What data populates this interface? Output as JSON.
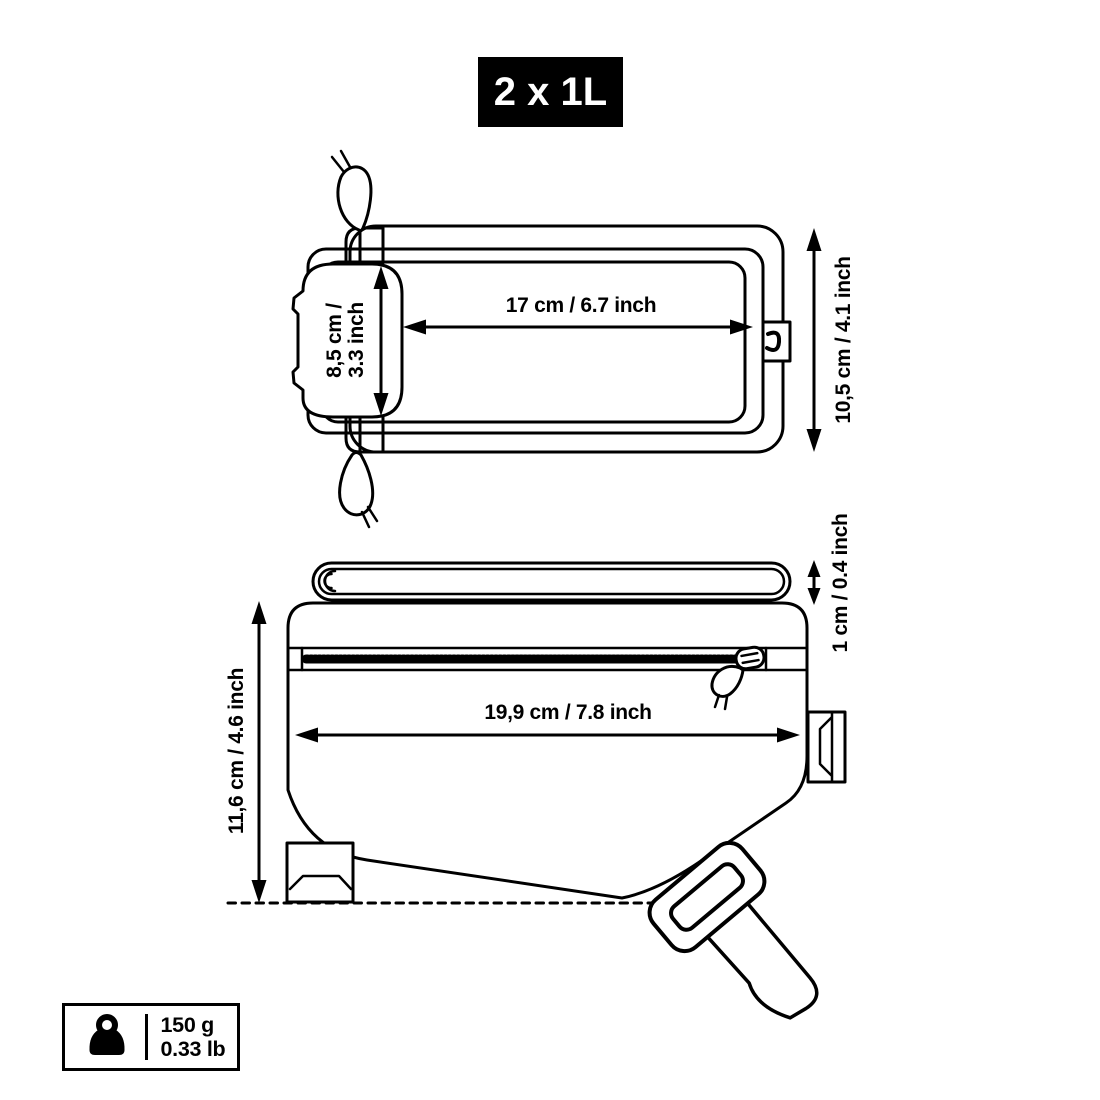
{
  "badge": {
    "label": "2 x 1L"
  },
  "top_view": {
    "width_label": "17 cm / 6.7 inch",
    "window_line1": "8,5 cm /",
    "window_line2": "3.3 inch",
    "height_label": "10,5 cm / 4.1 inch"
  },
  "side_view": {
    "length_label": "19,9 cm / 7.8 inch",
    "height_label": "11,6 cm / 4.6 inch",
    "flap_label": "1 cm / 0.4 inch"
  },
  "weight": {
    "grams": "150 g",
    "pounds": "0.33 lb",
    "icon": "weight-kettlebell-icon"
  },
  "colors": {
    "line": "#000000",
    "background": "#ffffff",
    "badge_bg": "#000000",
    "badge_text": "#ffffff"
  }
}
